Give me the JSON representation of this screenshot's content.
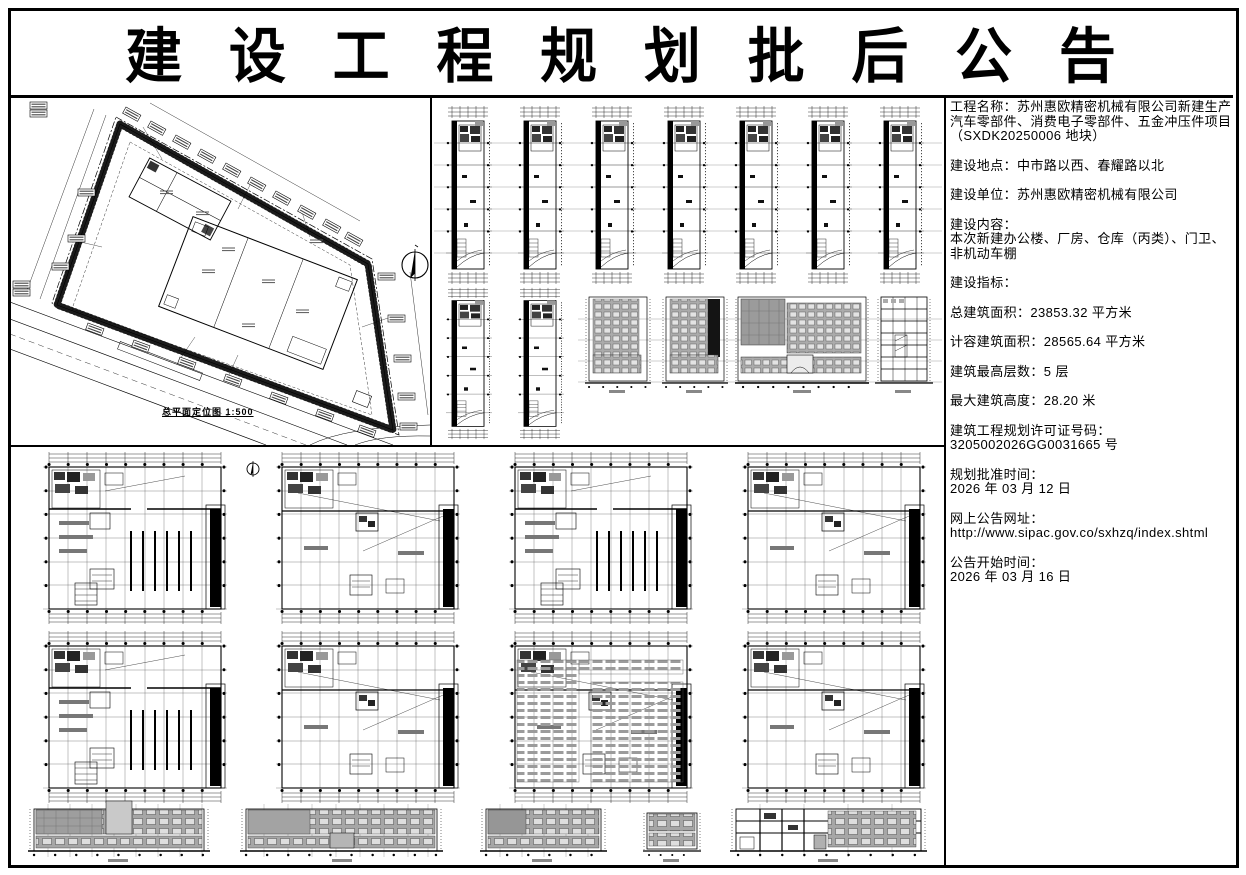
{
  "title": "建设工程规划批后公告",
  "site_plan": {
    "caption": "总平面定位图 1:500"
  },
  "info": {
    "project_name": "工程名称：苏州惠欧精密机械有限公司新建生产汽车零部件、消费电子零部件、五金冲压件项目（SXDK20250006 地块）",
    "location": "建设地点：中市路以西、春耀路以北",
    "builder": "建设单位：苏州惠欧精密机械有限公司",
    "content_label": "建设内容：",
    "content_value": "本次新建办公楼、厂房、仓库（丙类）、门卫、非机动车棚",
    "indicators_label": "建设指标：",
    "total_area": "总建筑面积：23853.32 平方米",
    "capacity_area": "计容建筑面积：28565.64 平方米",
    "max_floors": "建筑最高层数：5 层",
    "max_height": "最大建筑高度：28.20 米",
    "permit_label": "建筑工程规划许可证号码：",
    "permit_no": "3205002026GG0031665 号",
    "approval_label": "规划批准时间：",
    "approval_date": "2026 年 03 月 12 日",
    "url_label": "网上公告网址：",
    "url": "http://www.sipac.gov.co/sxhzq/index.shtml",
    "start_label": "公告开始时间：",
    "start_date": "2026 年 03 月 16 日"
  }
}
